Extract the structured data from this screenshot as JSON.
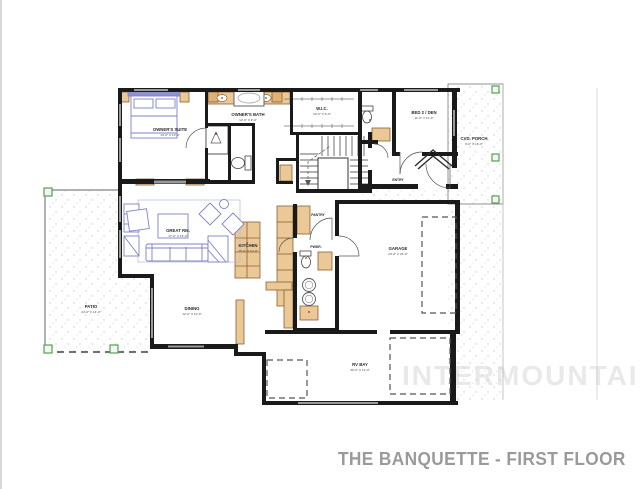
{
  "title": "THE BANQUETTE - FIRST FLOOR",
  "watermark": "INTERMOUNTAIN",
  "colors": {
    "wall": "#1a1a1a",
    "casework_tan": "#ebc996",
    "casework_outline": "#8d5f35",
    "furniture_blue": "#7d82c8",
    "post_green": "#55a055",
    "title_gray": "#9a9a9a",
    "watermark_gray": "#e9e9e9",
    "stipple_gray": "#c9c9c9"
  },
  "rooms": {
    "owners_suite": {
      "name": "OWNER'S SUITE",
      "dims": "14'-0\" X 13'-0\""
    },
    "owners_bath": {
      "name": "OWNER'S BATH",
      "dims": "12'-6\" X 9'-0\""
    },
    "wic": {
      "name": "W.I.C.",
      "dims": "10'-6\" X 6'-0\""
    },
    "bed2": {
      "name": "BED 2 / DEN",
      "dims": "11'-0\" X 11'-0\""
    },
    "porch": {
      "name": "CVD. PORCH",
      "dims": "9'-0\" X 16'-0\""
    },
    "entry": {
      "name": "ENTRY"
    },
    "patio": {
      "name": "PATIO",
      "dims": "24'-0\" X 14'-0\""
    },
    "great_room": {
      "name": "GREAT RM.",
      "dims": "17'-0\" X 15'-0\""
    },
    "kitchen": {
      "name": "KITCHEN",
      "dims": "15'-0\" X 10'-0\""
    },
    "dining": {
      "name": "DINING",
      "dims": "12'-0\" X 10'-6\""
    },
    "pantry": {
      "name": "PANTRY"
    },
    "powder": {
      "name": "PWDR."
    },
    "garage": {
      "name": "GARAGE",
      "dims": "23'-0\" X 23'-0\""
    },
    "shop": {
      "name": "RV BAY",
      "dims": "30'-0\" X 14'-0\""
    }
  }
}
